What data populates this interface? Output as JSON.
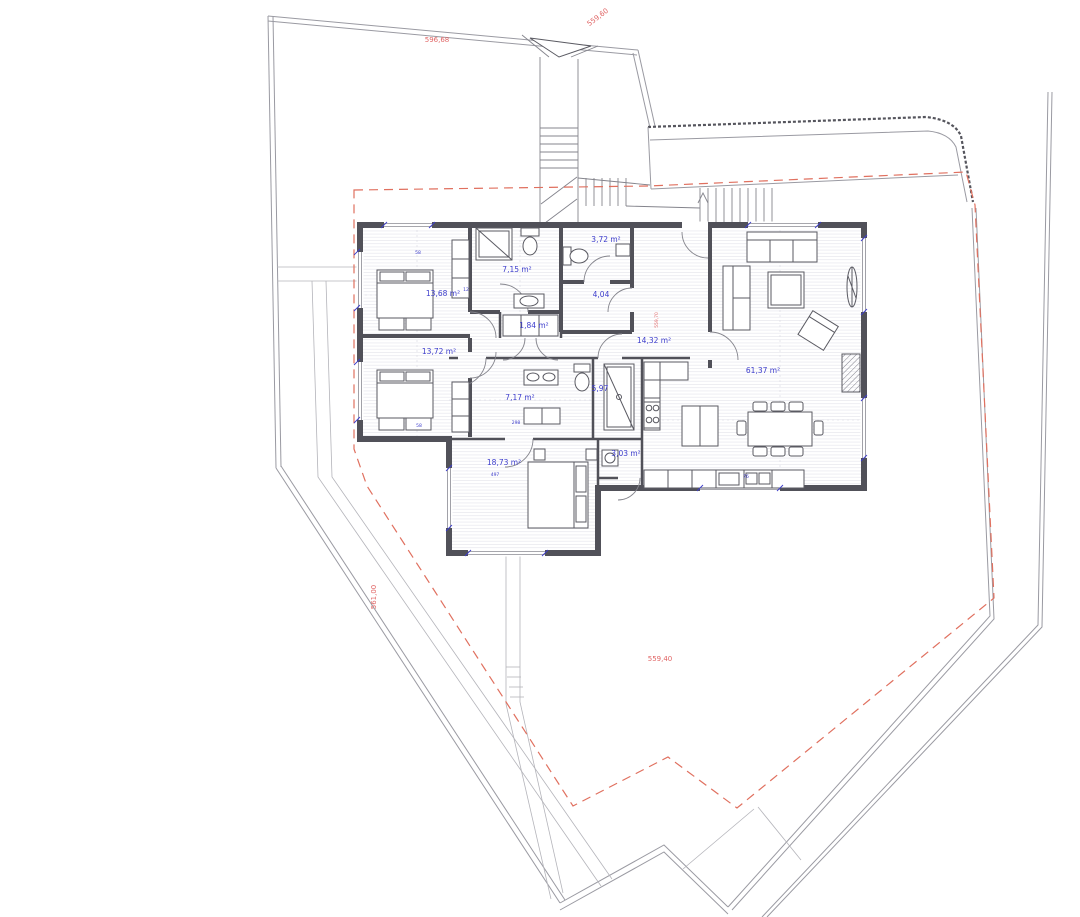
{
  "colors": {
    "wall": "#515159",
    "boundary": "#9a9aa2",
    "floor_hatch": "#e8e8ee",
    "area_label": "#3d3dcc",
    "elevation_label": "#e06464",
    "setback_line": "#e0705f"
  },
  "rooms": [
    {
      "name": "bedroom-1",
      "area": "13,68 m²"
    },
    {
      "name": "bedroom-2",
      "area": "13,72 m²"
    },
    {
      "name": "bathroom-1",
      "area": "7,15 m²"
    },
    {
      "name": "wc",
      "area": "3,72 m²"
    },
    {
      "name": "vestibule",
      "area": "4,04"
    },
    {
      "name": "hall-closet",
      "area": "1,84 m²"
    },
    {
      "name": "hall",
      "area": "14,32 m²"
    },
    {
      "name": "living-dining-kitchen",
      "area": "61,37 m²"
    },
    {
      "name": "bathroom-2",
      "area": "7,17 m²"
    },
    {
      "name": "shower-room",
      "area": "5,97"
    },
    {
      "name": "pantry",
      "area": "3,03 m²"
    },
    {
      "name": "bedroom-3",
      "area": "18,73 m²"
    }
  ],
  "elevations": [
    {
      "name": "north-boundary",
      "label": "596,68"
    },
    {
      "name": "northeast-boundary",
      "label": "559,60"
    },
    {
      "name": "west-terrain",
      "label": "561,00"
    },
    {
      "name": "south-terrain",
      "label": "559,40"
    },
    {
      "name": "entry-terrace",
      "label": "559,70"
    }
  ],
  "dimensions": [
    "58",
    "12",
    "58",
    "298",
    "497",
    "76"
  ]
}
